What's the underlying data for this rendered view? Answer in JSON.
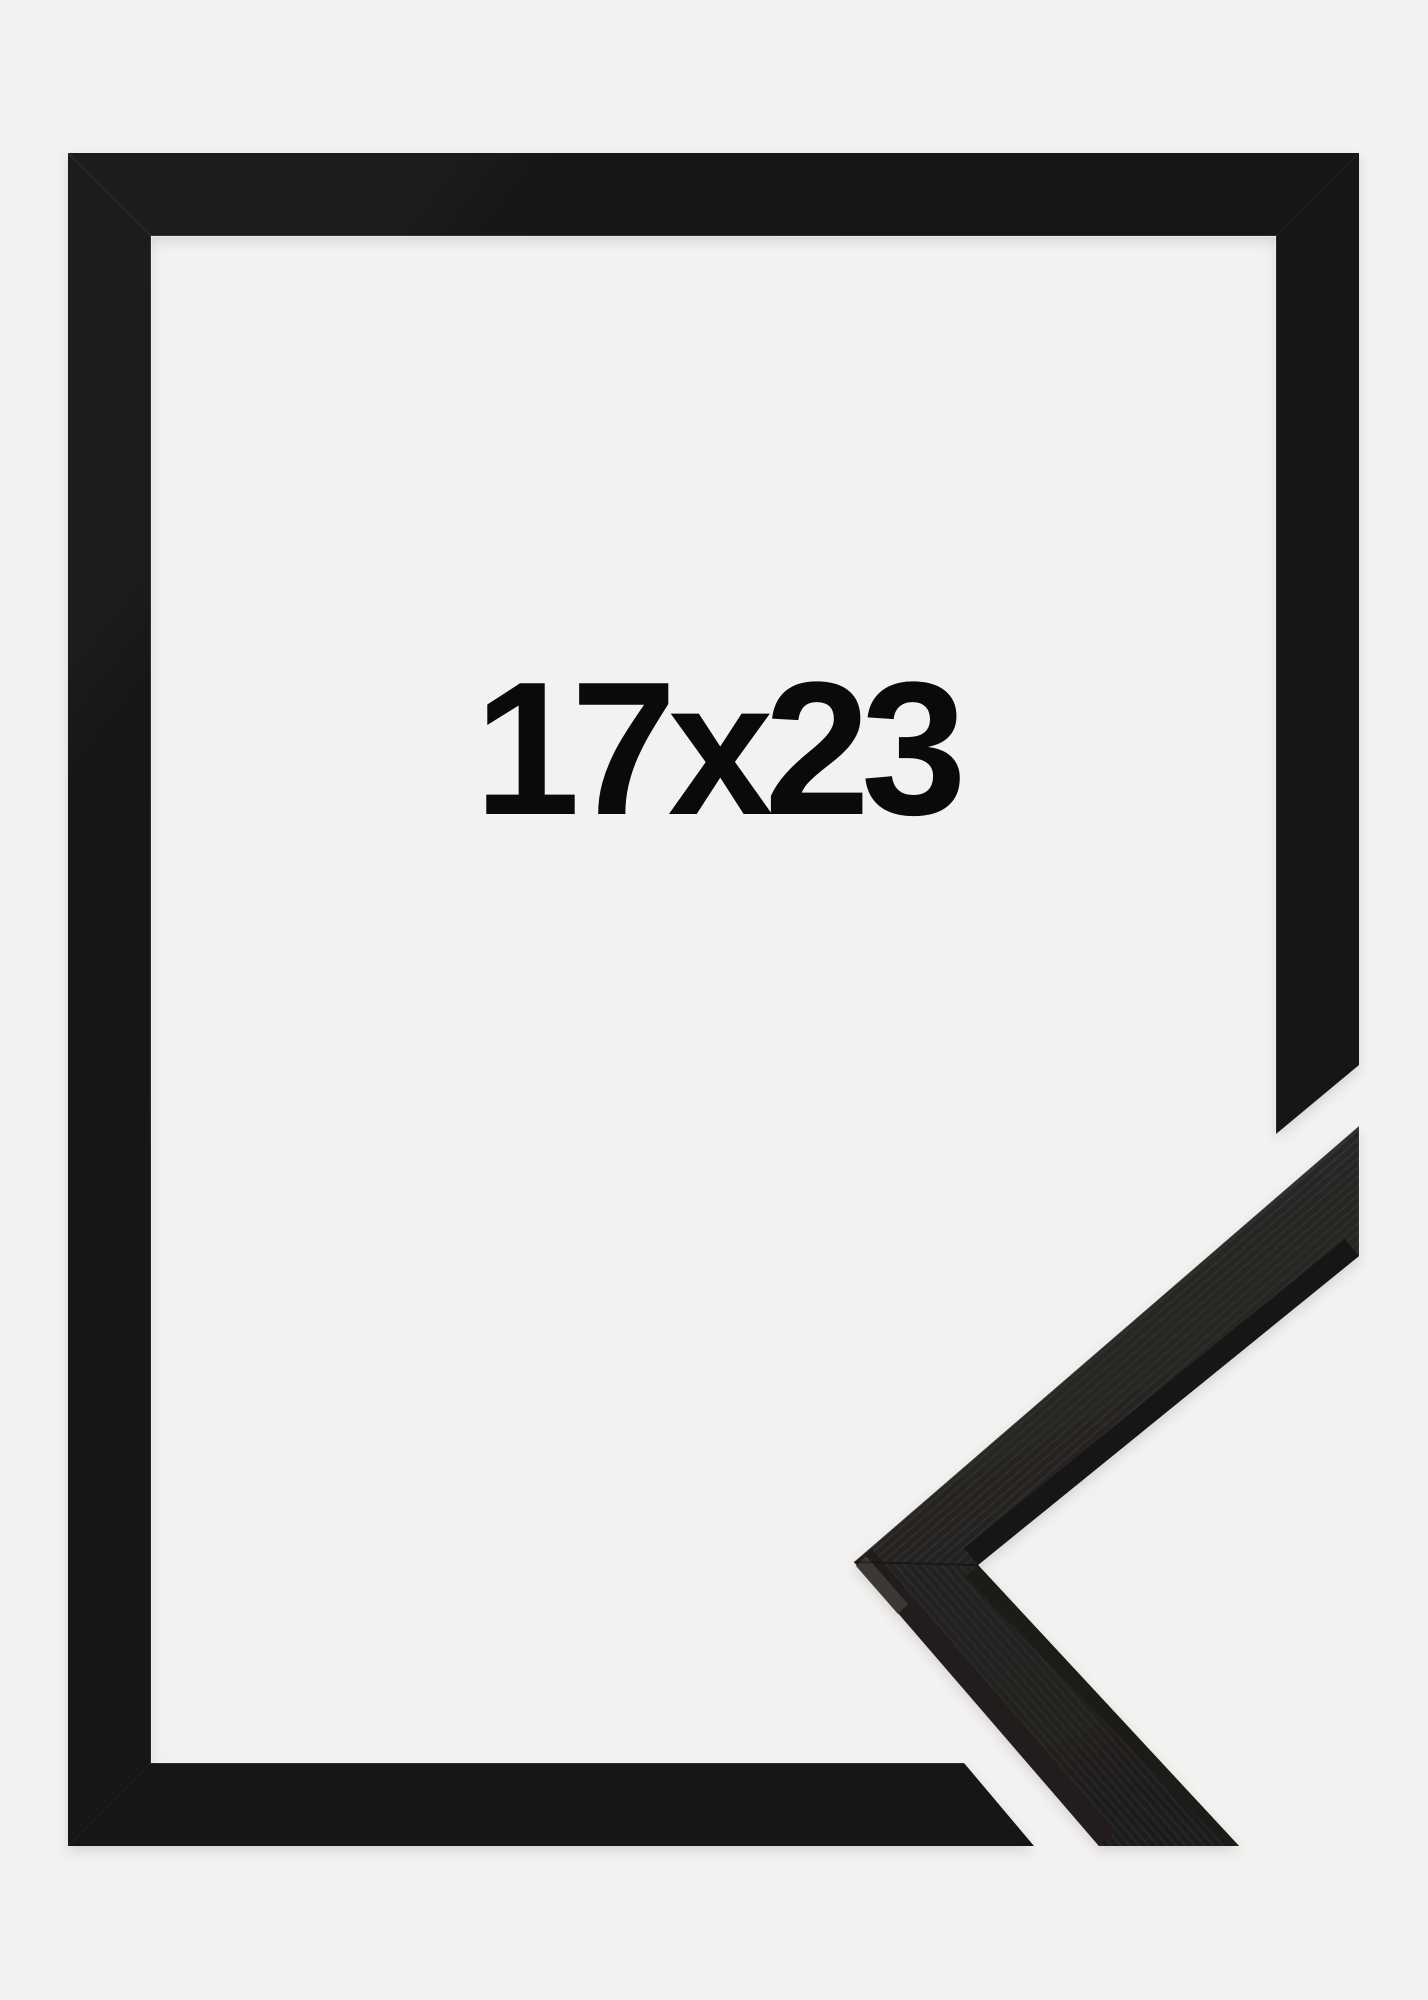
{
  "product": {
    "size_label": "17x23"
  },
  "colors": {
    "background": "#f3f2f1",
    "frame_black": "#161616",
    "moulding_face": "#2c2b29",
    "label": "#0a0a0a"
  }
}
